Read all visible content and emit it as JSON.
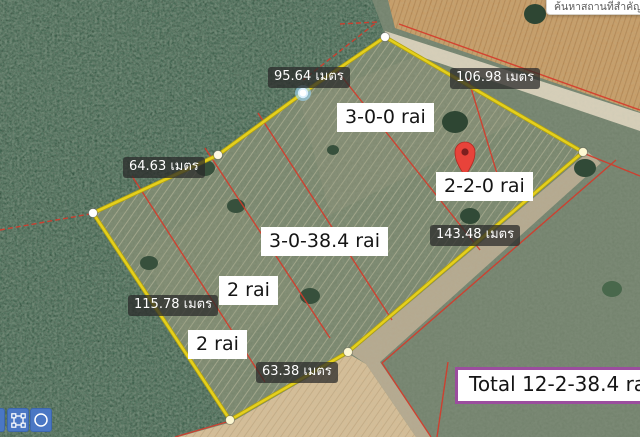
{
  "search": {
    "placeholder": "ค้นหาสถานที่สำคัญ"
  },
  "measurements": [
    {
      "label": "95.64 เมตร"
    },
    {
      "label": "64.63 เมตร"
    },
    {
      "label": "106.98 เมตร"
    },
    {
      "label": "115.78 เมตร"
    },
    {
      "label": "63.38 เมตร"
    },
    {
      "label": "143.48 เมตร"
    }
  ],
  "parcels": [
    {
      "label": "3-0-0 rai"
    },
    {
      "label": "2-2-0 rai"
    },
    {
      "label": "3-0-38.4 rai"
    },
    {
      "label": "2 rai"
    },
    {
      "label": "2 rai"
    }
  ],
  "total": {
    "label": "Total 12-2-38.4 rai"
  },
  "toolbar": {
    "buttons": [
      {
        "icon": "draw-polygon-icon"
      },
      {
        "icon": "draw-circle-icon"
      }
    ]
  },
  "colors": {
    "boundary_yellow": "#e5d01d",
    "parcel_red": "#d53a2a",
    "pin_red": "#e8433a",
    "button_blue": "#4a77c4",
    "total_border_purple": "#9b4d9e",
    "vertex_selected_halo": "#9bd2f0"
  }
}
